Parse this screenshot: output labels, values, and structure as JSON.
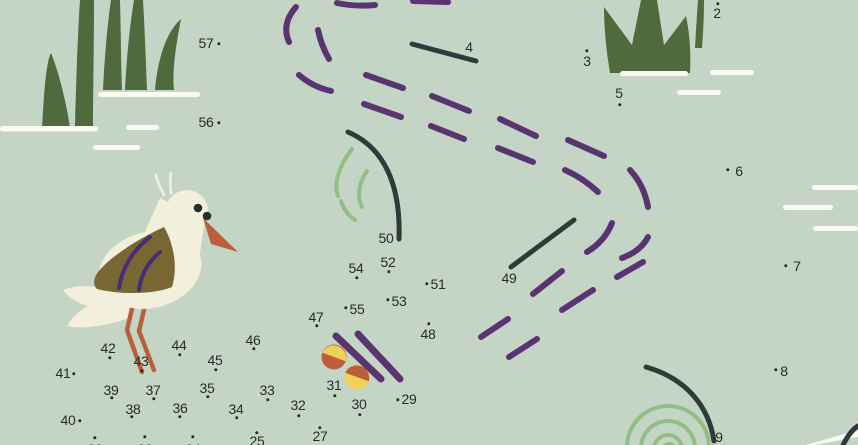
{
  "meta": {
    "app": "dot-to-dot-puzzle",
    "subject": "wading bird in a pond with grass tufts"
  },
  "colors": {
    "bg": "#c4d5c6",
    "green": "#4f6b3e",
    "lightgreen": "#93bd85",
    "purple": "#5a3470",
    "wingpurple": "#472d78",
    "dark": "#2f3b38",
    "ink": "#262c29",
    "cream": "#f3efdd",
    "white": "#fbfaef",
    "rust": "#bb5f3b",
    "olive": "#786733",
    "yellow": "#efd058"
  },
  "decor": {
    "bird": "bird-illustration",
    "grass_left": "grass-tuft",
    "grass_right": "grass-tuft",
    "ripples": "water-ripple-lines",
    "dashes": "dashed-trail",
    "berries": "berry-circles-decoration",
    "spiral": "green-spiral",
    "arcs": "green-arcs"
  },
  "puzzle": {
    "points": [
      {
        "n": "2",
        "lx": 717,
        "ly": 13,
        "dx": 718,
        "dy": 4
      },
      {
        "n": "3",
        "lx": 587,
        "ly": 61,
        "dx": 587,
        "dy": 51
      },
      {
        "n": "4",
        "lx": 469,
        "ly": 47,
        "dx": null,
        "dy": null
      },
      {
        "n": "5",
        "lx": 619,
        "ly": 93,
        "dx": 620,
        "dy": 105
      },
      {
        "n": "6",
        "lx": 739,
        "ly": 171,
        "dx": 728,
        "dy": 170
      },
      {
        "n": "7",
        "lx": 797,
        "ly": 266,
        "dx": 786,
        "dy": 266
      },
      {
        "n": "8",
        "lx": 784,
        "ly": 371,
        "dx": 776,
        "dy": 370
      },
      {
        "n": "9",
        "lx": 719,
        "ly": 437,
        "dx": null,
        "dy": null
      },
      {
        "n": "22",
        "lx": 95,
        "ly": 449,
        "dx": 95,
        "dy": 438
      },
      {
        "n": "23",
        "lx": 145,
        "ly": 449,
        "dx": 145,
        "dy": 437
      },
      {
        "n": "24",
        "lx": 193,
        "ly": 449,
        "dx": 193,
        "dy": 437
      },
      {
        "n": "25",
        "lx": 257,
        "ly": 441,
        "dx": 257,
        "dy": 433
      },
      {
        "n": "27",
        "lx": 320,
        "ly": 436,
        "dx": 320,
        "dy": 428
      },
      {
        "n": "29",
        "lx": 409,
        "ly": 399,
        "dx": 398,
        "dy": 400
      },
      {
        "n": "30",
        "lx": 359,
        "ly": 404,
        "dx": 360,
        "dy": 415
      },
      {
        "n": "31",
        "lx": 334,
        "ly": 385,
        "dx": 335,
        "dy": 396
      },
      {
        "n": "32",
        "lx": 298,
        "ly": 405,
        "dx": 299,
        "dy": 416
      },
      {
        "n": "33",
        "lx": 267,
        "ly": 390,
        "dx": 268,
        "dy": 400
      },
      {
        "n": "34",
        "lx": 236,
        "ly": 409,
        "dx": 237,
        "dy": 418
      },
      {
        "n": "35",
        "lx": 207,
        "ly": 388,
        "dx": 208,
        "dy": 397
      },
      {
        "n": "36",
        "lx": 180,
        "ly": 408,
        "dx": 180,
        "dy": 417
      },
      {
        "n": "37",
        "lx": 153,
        "ly": 390,
        "dx": 154,
        "dy": 399
      },
      {
        "n": "38",
        "lx": 133,
        "ly": 409,
        "dx": 132,
        "dy": 417
      },
      {
        "n": "39",
        "lx": 111,
        "ly": 390,
        "dx": 112,
        "dy": 398
      },
      {
        "n": "40",
        "lx": 68,
        "ly": 420,
        "dx": 80,
        "dy": 421
      },
      {
        "n": "41",
        "lx": 63,
        "ly": 373,
        "dx": 74,
        "dy": 374
      },
      {
        "n": "42",
        "lx": 108,
        "ly": 348,
        "dx": 110,
        "dy": 358
      },
      {
        "n": "43",
        "lx": 141,
        "ly": 361,
        "dx": 142,
        "dy": 371
      },
      {
        "n": "44",
        "lx": 179,
        "ly": 345,
        "dx": 180,
        "dy": 355
      },
      {
        "n": "45",
        "lx": 215,
        "ly": 360,
        "dx": 216,
        "dy": 370
      },
      {
        "n": "46",
        "lx": 253,
        "ly": 340,
        "dx": 254,
        "dy": 349
      },
      {
        "n": "47",
        "lx": 316,
        "ly": 317,
        "dx": 317,
        "dy": 326
      },
      {
        "n": "48",
        "lx": 428,
        "ly": 334,
        "dx": 429,
        "dy": 324
      },
      {
        "n": "49",
        "lx": 509,
        "ly": 278,
        "dx": null,
        "dy": null
      },
      {
        "n": "50",
        "lx": 386,
        "ly": 238,
        "dx": null,
        "dy": null
      },
      {
        "n": "51",
        "lx": 438,
        "ly": 284,
        "dx": 427,
        "dy": 284
      },
      {
        "n": "52",
        "lx": 388,
        "ly": 262,
        "dx": 389,
        "dy": 272
      },
      {
        "n": "53",
        "lx": 399,
        "ly": 301,
        "dx": 388,
        "dy": 300
      },
      {
        "n": "54",
        "lx": 356,
        "ly": 268,
        "dx": 357,
        "dy": 278
      },
      {
        "n": "55",
        "lx": 357,
        "ly": 309,
        "dx": 346,
        "dy": 308
      },
      {
        "n": "56",
        "lx": 206,
        "ly": 122,
        "dx": 219,
        "dy": 123
      },
      {
        "n": "57",
        "lx": 206,
        "ly": 43,
        "dx": 219,
        "dy": 44
      }
    ]
  }
}
